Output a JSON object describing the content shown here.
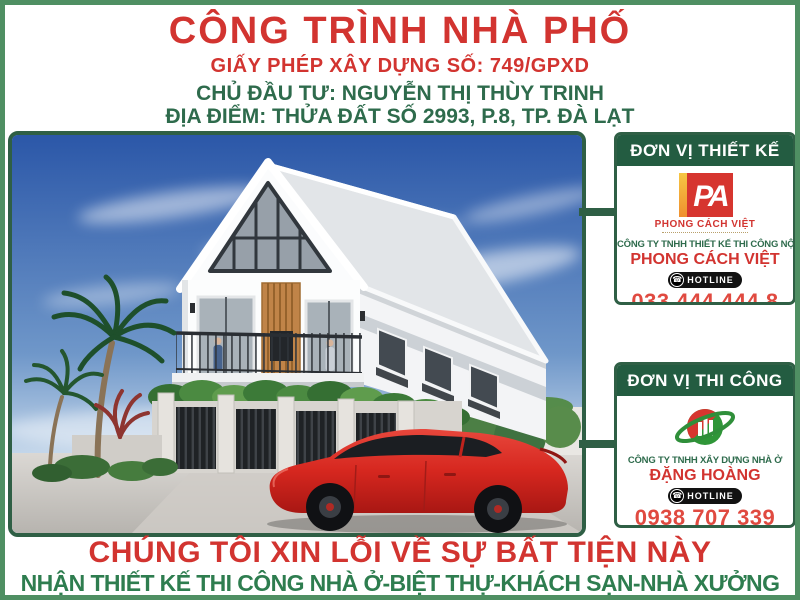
{
  "header": {
    "title": "CÔNG TRÌNH NHÀ PHỐ",
    "permit": "GIẤY PHÉP XÂY DỰNG SỐ: 749/GPXD",
    "investor": "CHỦ ĐẦU TƯ: NGUYỄN THỊ THÙY TRINH",
    "location": "ĐỊA ĐIỂM: THỬA ĐẤT SỐ 2993, P.8, TP. ĐÀ LẠT"
  },
  "design_panel": {
    "header": "ĐƠN VỊ THIẾT KẾ",
    "logo_monogram": "PA",
    "logo_name": "PHONG CÁCH VIỆT",
    "company_line1": "CÔNG TY TNHH THIẾT KẾ THI CÔNG NỘI THẤT",
    "company_line2": "PHONG CÁCH VIỆT",
    "hotline_label": "HOTLINE",
    "phone": "033 444 444 8",
    "website": "www.phongcachvietdesign.com"
  },
  "construction_panel": {
    "header": "ĐƠN VỊ THI CÔNG",
    "company_line1": "CÔNG TY TNHH XÂY DỰNG NHÀ Ở",
    "company_line2": "ĐẶNG HOÀNG",
    "hotline_label": "HOTLINE",
    "phone": "0938 707 339",
    "website": "www.danghoang.com.vn"
  },
  "footer": {
    "line1": "CHÚNG TÔI XIN LỖI VỀ SỰ BẤT TIỆN NÀY",
    "line2": "NHẬN THIẾT KẾ THI CÔNG NHÀ Ở-BIỆT THỰ-KHÁCH SẠN-NHÀ XƯỞNG"
  },
  "colors": {
    "title_red": "#d23430",
    "info_green": "#2e6b4c",
    "panel_header_green": "#235c41",
    "frame_green": "#4f8f63",
    "border_dark_green": "#2f5f45",
    "phone_red": "#e04a40",
    "link_blue": "#1a6fc4",
    "footer_green": "#2e7d4f",
    "logo_yellow": "#f2b233",
    "logo_red": "#d6352f",
    "logo_green": "#2f9638"
  }
}
